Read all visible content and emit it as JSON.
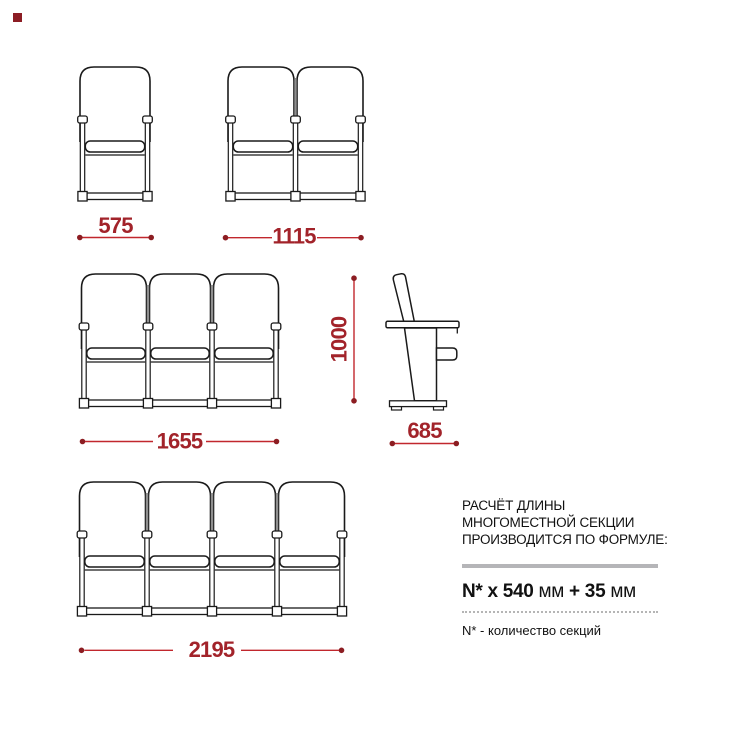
{
  "dimensions": {
    "single_width": "575",
    "double_width": "1115",
    "triple_width": "1655",
    "quad_width": "2195",
    "height": "1000",
    "depth": "685"
  },
  "info": {
    "title_lines": [
      "РАСЧЁТ ДЛИНЫ",
      "МНОГОМЕСТНОЙ СЕКЦИИ",
      "ПРОИЗВОДИТСЯ ПО ФОРМУЛЕ:"
    ],
    "formula": {
      "bold1": "N* x 540",
      "reg1": " мм ",
      "bold2": "+ 35",
      "reg2": " мм"
    },
    "note": "N* - количество секций"
  },
  "colors": {
    "dim_line": "#c1272d",
    "dim_dot": "#8c1d22",
    "dim_text": "#a2232a",
    "drawing_stroke": "#1a1a1a",
    "rule_gray": "#b5b5b8",
    "logo": "#8c1d24",
    "text": "#111111"
  },
  "figures": {
    "front_sections": [
      {
        "name": "front-view-1-seat",
        "seats": 1,
        "x": 82.5,
        "top": 65,
        "spacing": 65
      },
      {
        "name": "front-view-2-seat",
        "seats": 2,
        "x": 230.5,
        "top": 65,
        "spacing": 65
      },
      {
        "name": "front-view-3-seat",
        "seats": 3,
        "x": 84,
        "top": 272,
        "spacing": 64
      },
      {
        "name": "front-view-4-seat",
        "seats": 4,
        "x": 82,
        "top": 480,
        "spacing": 65
      }
    ]
  }
}
